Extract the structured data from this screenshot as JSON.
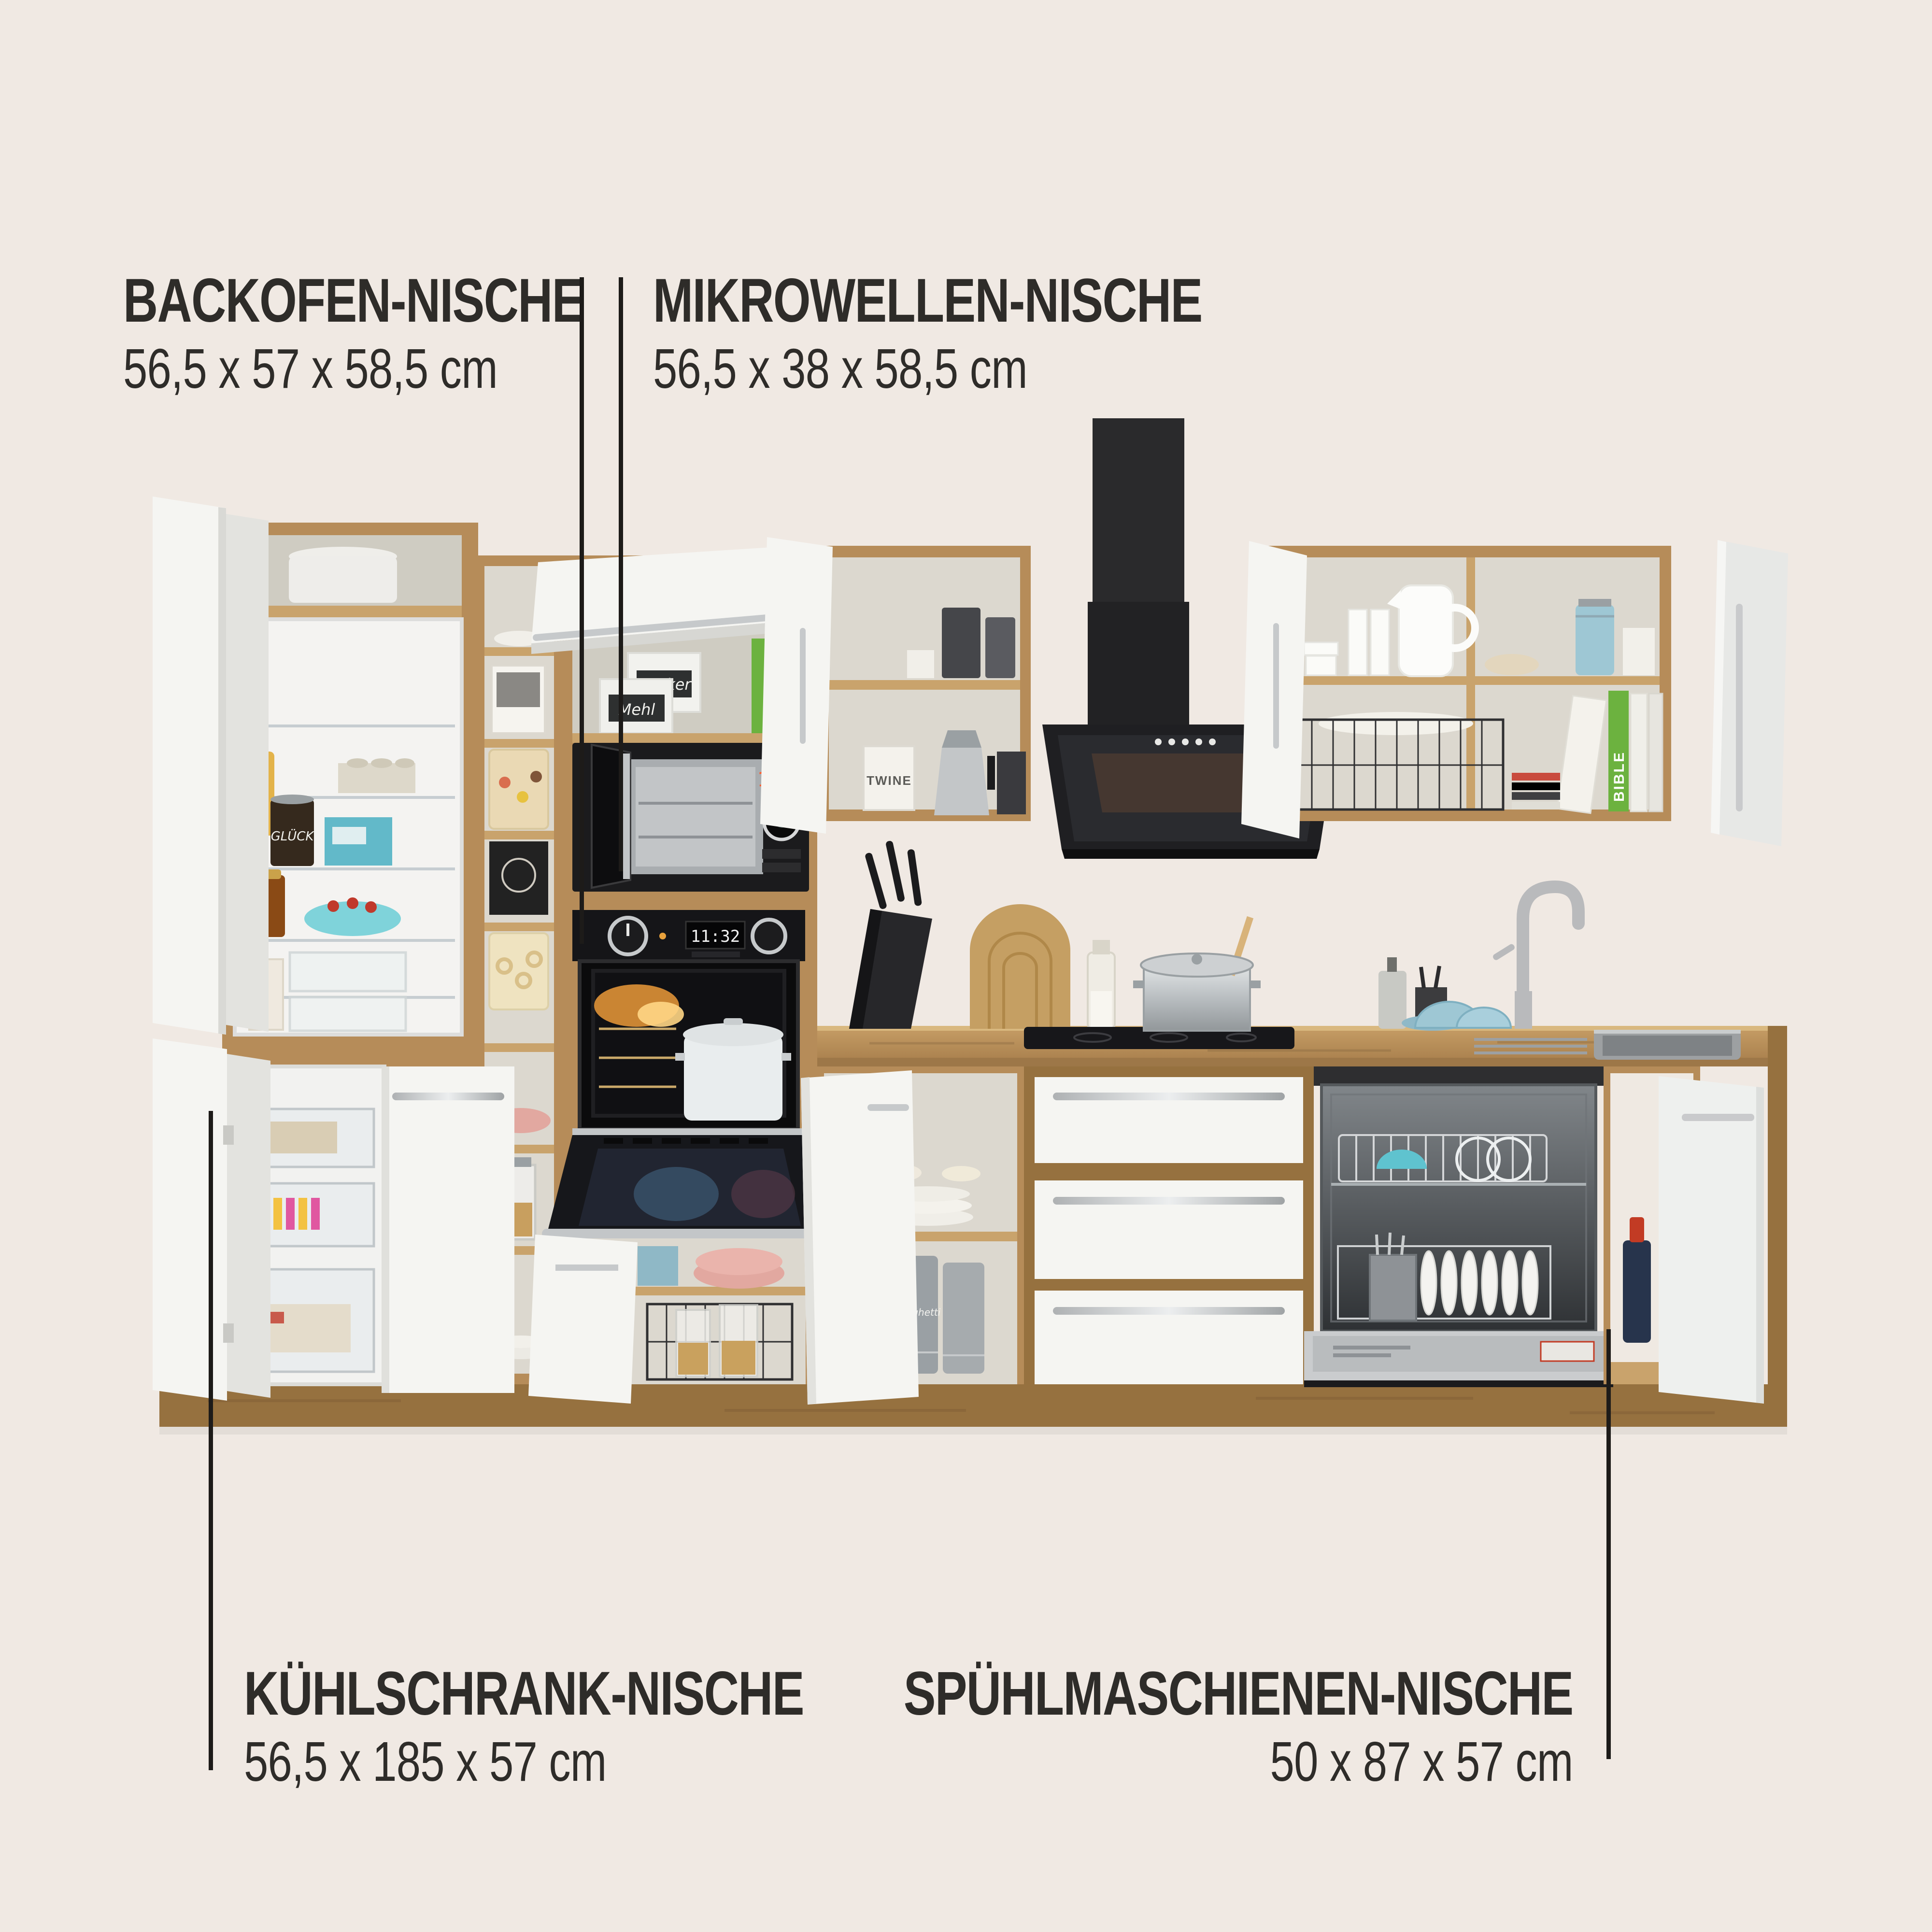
{
  "annotations": {
    "backofen": {
      "title": "BACKOFEN-NISCHE",
      "dimensions": "56,5 x 57 x 58,5 cm"
    },
    "mikrowellen": {
      "title": "MIKROWELLEN-NISCHE",
      "dimensions": "56,5 x 38 x 58,5 cm"
    },
    "kuehlschrank": {
      "title": "KÜHLSCHRANK-NISCHE",
      "dimensions": "56,5 x 185 x 57 cm"
    },
    "spuelmaschine": {
      "title": "SPÜHLMASCHIENEN-NISCHE",
      "dimensions": "50 x 87 x 57 cm"
    }
  },
  "scene": {
    "microwave_display": "1132",
    "oven_display": "11:32",
    "zucker": "Zucker",
    "mehl": "Mehl",
    "glueck": "GLÜCK",
    "twine": "TWINE",
    "bible": "BIBLE",
    "spaghetti": "Spaghetti"
  },
  "colors": {
    "bg": "#f0e9e3",
    "ink": "#2e2c29",
    "line": "#1d1b19",
    "wood": "#b68c59",
    "wood_light": "#c9a36c",
    "wood_dark": "#96713f",
    "door": "#f5f5f2",
    "door_shade": "#e3e3df",
    "interior": "#dcd8cf",
    "interior_dim": "#cfccc2",
    "black": "#1b1b1d",
    "steel": "#c3c6c8",
    "steel_dim": "#9aa0a3",
    "accent_blue": "#9ec7d4",
    "accent_pink": "#e2a8a0",
    "accent_red": "#c23b24",
    "accent_green": "#6cb23f",
    "accent_yellow": "#e3b34a",
    "display_red": "#ff5a2a"
  }
}
